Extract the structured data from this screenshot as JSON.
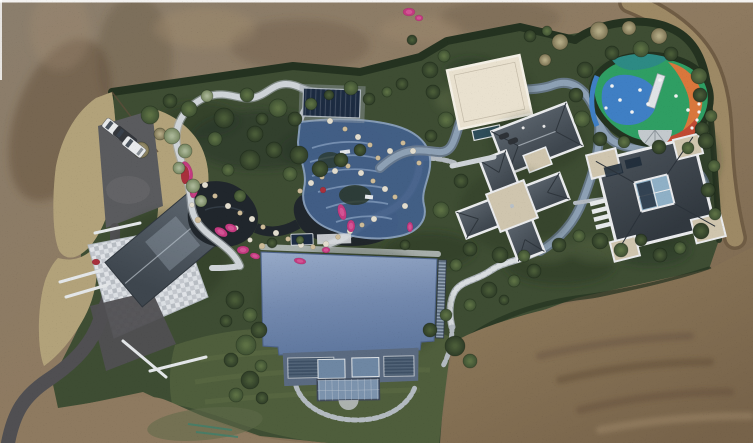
{
  "palette": {
    "dirt_gray": "#8b7e6d",
    "dirt_base": "#8e7a60",
    "dirt_deep": "#77634a",
    "dirt_warm": "#927e5e",
    "dirt_shadow": "#5e4b38",
    "dirt_highlight": "#a79070",
    "dirt_road_light": "#9d8965",
    "dirt_road_dark": "#6f5c44",
    "dry_grass": "#b2a27a",
    "dry_grass_dark": "#7c7050",
    "garden_green": "#3e4d33",
    "garden_shadow": "#283524",
    "lawn_green": "#4f5e3c",
    "lawn_light": "#5d6c45",
    "hedge_dark": "#243220",
    "path_white": "#ced3d7",
    "path_stone": "#b3bac0",
    "path_edge": "#a6adb3",
    "track_outer": "#6b7c90",
    "track_inner": "#8da0b4",
    "road_asphalt": "#504f52",
    "parking_gray": "#5a5b5e",
    "water_dark": "#20262c",
    "water_glint": "#45525e",
    "pool_navy": "#1d2c42",
    "terrace_blue": "#43608a",
    "terrace_step": "#7e97b8",
    "terrace_rim": "#89a0bd",
    "roof_blue_light": "#97aac8",
    "roof_blue": "#7389ae",
    "roof_blue_deep": "#60789f",
    "slate_hi": "#5b646d",
    "slate_lo": "#3e464e",
    "slate2_hi": "#4a525a",
    "slate2_lo": "#31383f",
    "roof_edge": "#e9eaec",
    "cream_roof": "#e9e1cf",
    "cream_edge": "#f3efe5",
    "stone_pale": "#d9dbdf",
    "mosaic_a": "#e0e3e7",
    "mosaic_b": "#c3c7cd",
    "tan_flat": "#cfc5ae",
    "glass_blue": "#8fb0c6",
    "facade_louver": "#2f4258",
    "facade_glass": "#6e87a3",
    "conservatory": "#7c93ad",
    "flower_pink": "#c23a7f",
    "flower_red": "#a8303c",
    "flower_hi": "#e06aa5",
    "rock_tan": "#cdbb98",
    "rock_light": "#e2ddcf",
    "car_white": "#e8eaec",
    "car_dark": "#34373c",
    "play_green": "#2f9e63",
    "play_blue": "#3f7fc4",
    "play_orange": "#d9773c",
    "play_red": "#c04a33",
    "play_teal": "#2d8a84",
    "play_gray": "#c3c9cd",
    "bush_dark": "#2e3c27",
    "bush_dark_hi": "#4a5c38",
    "bush_mid": "#3f5133",
    "bush_mid_hi": "#5d7144",
    "bush_light": "#75855f",
    "bush_light_hi": "#a9b596",
    "bush_tan": "#7d7454",
    "bush_tan_hi": "#b3aa85",
    "wall_white": "#e3e6e8",
    "stain_green": "#5f6a49",
    "stain_teal": "#3f7f6b",
    "frame_white": "#ffffff"
  },
  "scene": {
    "description": "Aerial drone view of a landscaped estate surrounded by bare graded earth: blue metal-roof main house, stone-courtyard house, two slate hip-roof villas, cream flat-roof pavilion, koi ponds with winding white stone paths, navy pool cover, blue stepped water terrace, colorful children's playground, grey winding track, parking with cars and a dirt road.",
    "ground": {
      "surround": "bare brown earth",
      "left_strip": "dry tan grass",
      "bottom": "green lawn over graded dirt with green paint stain",
      "right_edge": "dirt track road"
    },
    "buildings": [
      {
        "id": "courtyard-house",
        "roof": "dark slate gable",
        "paving": "pale stone mosaic courtyard"
      },
      {
        "id": "main-house",
        "roof": "blue standing-seam metal",
        "features": "glass conservatory and louvered window bands"
      },
      {
        "id": "villa-upper",
        "roof": "slate hip with white parapet"
      },
      {
        "id": "villa-lower",
        "roof": "slate cross-plan with white parapet and tan center"
      },
      {
        "id": "east-villa",
        "roof": "slate pinwheel with central glass court"
      },
      {
        "id": "cream-pavilion",
        "roof": "cream flat roof"
      }
    ],
    "water": {
      "ponds": 2,
      "pool_cover": "navy rectangle",
      "terrace": "blue stepped cascade with rocks"
    },
    "playground": {
      "surface_colors": [
        "green",
        "blue",
        "orange",
        "red",
        "teal"
      ],
      "equipment": "slide, fan awning and climbing dots"
    },
    "vehicles": {
      "cars": [
        {
          "cx": 114,
          "cy": 129,
          "angle": 38,
          "type": "white"
        },
        {
          "cx": 125,
          "cy": 137,
          "angle": 38,
          "type": "dark"
        },
        {
          "cx": 134,
          "cy": 147,
          "angle": 38,
          "type": "white"
        },
        {
          "cx": 504,
          "cy": 136,
          "angle": -20,
          "type": "mini"
        },
        {
          "cx": 513,
          "cy": 141,
          "angle": -20,
          "type": "mini"
        }
      ]
    },
    "vegetation": {
      "bushes": [
        [
          150,
          115,
          9,
          "mid"
        ],
        [
          170,
          101,
          7,
          "dark"
        ],
        [
          189,
          109,
          8,
          "mid"
        ],
        [
          207,
          96,
          6,
          "light"
        ],
        [
          224,
          118,
          10,
          "dark"
        ],
        [
          247,
          95,
          7,
          "mid"
        ],
        [
          262,
          119,
          6,
          "dark"
        ],
        [
          278,
          108,
          9,
          "mid"
        ],
        [
          295,
          119,
          7,
          "dark"
        ],
        [
          311,
          104,
          6,
          "mid"
        ],
        [
          329,
          95,
          5,
          "dark"
        ],
        [
          351,
          88,
          7,
          "mid"
        ],
        [
          369,
          99,
          6,
          "dark"
        ],
        [
          387,
          92,
          5,
          "mid"
        ],
        [
          402,
          84,
          6,
          "dark"
        ],
        [
          255,
          134,
          8,
          "dark"
        ],
        [
          215,
          139,
          7,
          "mid"
        ],
        [
          160,
          134,
          6,
          "tan"
        ],
        [
          141,
          150,
          8,
          "tan"
        ],
        [
          250,
          160,
          10,
          "dark"
        ],
        [
          274,
          150,
          8,
          "dark"
        ],
        [
          299,
          155,
          9,
          "dark"
        ],
        [
          320,
          169,
          8,
          "dark"
        ],
        [
          341,
          160,
          7,
          "dark"
        ],
        [
          360,
          150,
          6,
          "dark"
        ],
        [
          290,
          174,
          7,
          "mid"
        ],
        [
          240,
          196,
          6,
          "mid"
        ],
        [
          228,
          170,
          6,
          "mid"
        ],
        [
          430,
          70,
          8,
          "dark"
        ],
        [
          444,
          56,
          6,
          "mid"
        ],
        [
          433,
          92,
          7,
          "dark"
        ],
        [
          530,
          36,
          6,
          "dark"
        ],
        [
          547,
          31,
          5,
          "mid"
        ],
        [
          412,
          40,
          5,
          "dark"
        ],
        [
          560,
          42,
          8,
          "tan"
        ],
        [
          599,
          31,
          9,
          "tan"
        ],
        [
          629,
          28,
          7,
          "tan"
        ],
        [
          659,
          36,
          8,
          "tan"
        ],
        [
          545,
          60,
          6,
          "tan"
        ],
        [
          585,
          70,
          8,
          "dark"
        ],
        [
          576,
          95,
          7,
          "dark"
        ],
        [
          582,
          119,
          8,
          "mid"
        ],
        [
          600,
          139,
          7,
          "dark"
        ],
        [
          624,
          142,
          6,
          "mid"
        ],
        [
          659,
          147,
          7,
          "dark"
        ],
        [
          688,
          148,
          6,
          "mid"
        ],
        [
          702,
          129,
          7,
          "dark"
        ],
        [
          699,
          76,
          8,
          "mid"
        ],
        [
          671,
          54,
          7,
          "dark"
        ],
        [
          641,
          49,
          8,
          "mid"
        ],
        [
          612,
          53,
          7,
          "dark"
        ],
        [
          446,
          120,
          8,
          "mid"
        ],
        [
          431,
          136,
          6,
          "dark"
        ],
        [
          461,
          181,
          7,
          "dark"
        ],
        [
          441,
          210,
          8,
          "mid"
        ],
        [
          470,
          249,
          7,
          "dark"
        ],
        [
          456,
          265,
          6,
          "mid"
        ],
        [
          500,
          255,
          8,
          "dark"
        ],
        [
          524,
          256,
          6,
          "mid"
        ],
        [
          559,
          245,
          7,
          "dark"
        ],
        [
          579,
          236,
          6,
          "mid"
        ],
        [
          600,
          241,
          8,
          "dark"
        ],
        [
          621,
          250,
          7,
          "mid"
        ],
        [
          641,
          240,
          6,
          "dark"
        ],
        [
          489,
          290,
          8,
          "dark"
        ],
        [
          514,
          281,
          6,
          "mid"
        ],
        [
          534,
          271,
          7,
          "dark"
        ],
        [
          470,
          305,
          6,
          "mid"
        ],
        [
          504,
          300,
          5,
          "dark"
        ],
        [
          660,
          255,
          7,
          "dark"
        ],
        [
          680,
          248,
          6,
          "mid"
        ],
        [
          700,
          95,
          7,
          "dark"
        ],
        [
          711,
          116,
          6,
          "mid"
        ],
        [
          706,
          141,
          8,
          "dark"
        ],
        [
          714,
          166,
          6,
          "mid"
        ],
        [
          708,
          190,
          7,
          "dark"
        ],
        [
          715,
          214,
          6,
          "mid"
        ],
        [
          701,
          231,
          8,
          "dark"
        ],
        [
          250,
          380,
          9,
          "dark"
        ],
        [
          236,
          395,
          7,
          "mid"
        ],
        [
          262,
          398,
          6,
          "dark"
        ],
        [
          430,
          330,
          7,
          "dark"
        ],
        [
          446,
          315,
          6,
          "mid"
        ],
        [
          455,
          346,
          10,
          "dark"
        ],
        [
          470,
          361,
          7,
          "mid"
        ],
        [
          272,
          243,
          5,
          "dark"
        ],
        [
          300,
          240,
          4,
          "mid"
        ],
        [
          405,
          245,
          5,
          "dark"
        ],
        [
          235,
          300,
          9,
          "dark"
        ],
        [
          250,
          315,
          7,
          "mid"
        ],
        [
          226,
          321,
          6,
          "dark"
        ],
        [
          259,
          330,
          8,
          "dark"
        ],
        [
          246,
          345,
          10,
          "mid"
        ],
        [
          231,
          360,
          7,
          "dark"
        ],
        [
          261,
          366,
          6,
          "mid"
        ],
        [
          172,
          136,
          8,
          "light"
        ],
        [
          185,
          151,
          7,
          "light"
        ],
        [
          179,
          168,
          6,
          "light"
        ],
        [
          193,
          186,
          7,
          "light"
        ],
        [
          201,
          201,
          6,
          "light"
        ]
      ],
      "rocks": [
        [
          205,
          185,
          3
        ],
        [
          215,
          196,
          2.5
        ],
        [
          228,
          206,
          3
        ],
        [
          240,
          213,
          2.5
        ],
        [
          252,
          219,
          3
        ],
        [
          263,
          227,
          2.5
        ],
        [
          276,
          233,
          3
        ],
        [
          288,
          239,
          2.5
        ],
        [
          301,
          245,
          3
        ],
        [
          313,
          247,
          2.5
        ],
        [
          326,
          244,
          3
        ],
        [
          338,
          237,
          2.5
        ],
        [
          350,
          231,
          3
        ],
        [
          362,
          225,
          2.5
        ],
        [
          374,
          219,
          3
        ],
        [
          300,
          191,
          2.5
        ],
        [
          311,
          183,
          3
        ],
        [
          322,
          177,
          2.5
        ],
        [
          335,
          171,
          3
        ],
        [
          348,
          166,
          2.5
        ],
        [
          361,
          173,
          3
        ],
        [
          373,
          181,
          2.5
        ],
        [
          385,
          189,
          3
        ],
        [
          395,
          197,
          2.5
        ],
        [
          405,
          206,
          3
        ],
        [
          378,
          158,
          2.5
        ],
        [
          390,
          151,
          3
        ],
        [
          403,
          143,
          2.5
        ],
        [
          413,
          151,
          3
        ],
        [
          419,
          163,
          2.5
        ],
        [
          330,
          121,
          3
        ],
        [
          345,
          129,
          2.5
        ],
        [
          358,
          137,
          3
        ],
        [
          370,
          145,
          2.5
        ],
        [
          250,
          240,
          2.5
        ],
        [
          262,
          246,
          3
        ],
        [
          236,
          228,
          2.5
        ],
        [
          198,
          220,
          3
        ],
        [
          192,
          205,
          2.5
        ]
      ],
      "flowers": [
        [
          187,
          171,
          5,
          10,
          -20,
          "pink"
        ],
        [
          194,
          190,
          4,
          8,
          10,
          "pink"
        ],
        [
          221,
          232,
          7,
          4,
          30,
          "pink"
        ],
        [
          231,
          228,
          6,
          4,
          20,
          "pink"
        ],
        [
          243,
          250,
          6,
          4,
          0,
          "pink"
        ],
        [
          342,
          212,
          4,
          8,
          -15,
          "pink"
        ],
        [
          351,
          226,
          4,
          6,
          0,
          "pink"
        ],
        [
          300,
          261,
          6,
          3,
          10,
          "pink"
        ],
        [
          326,
          250,
          4,
          3,
          0,
          "pink"
        ],
        [
          409,
          12,
          6,
          4,
          0,
          "pink"
        ],
        [
          419,
          18,
          4,
          3,
          0,
          "pink"
        ],
        [
          185,
          175,
          4,
          9,
          0,
          "red"
        ],
        [
          96,
          262,
          4,
          3,
          0,
          "red"
        ],
        [
          323,
          190,
          3,
          3,
          0,
          "red"
        ],
        [
          255,
          256,
          5,
          3,
          15,
          "pink"
        ],
        [
          410,
          227,
          3,
          5,
          0,
          "pink"
        ]
      ]
    }
  }
}
